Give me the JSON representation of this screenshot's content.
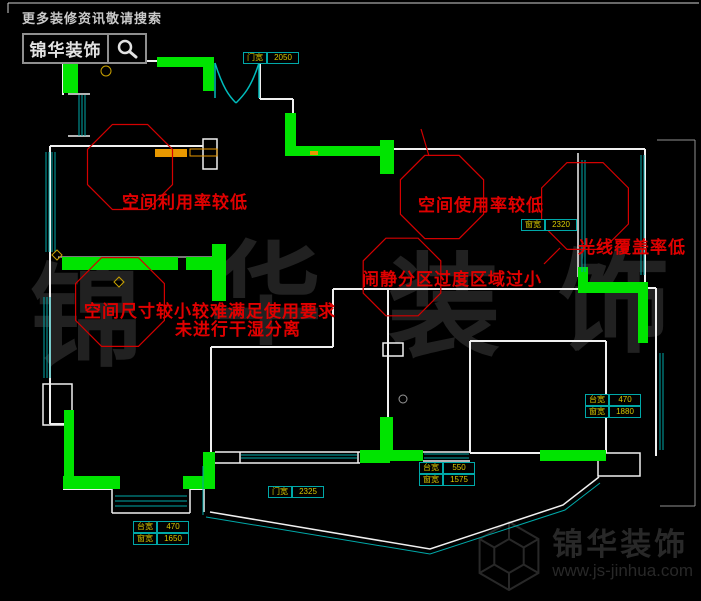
{
  "header": {
    "tagline": "更多装修资讯敬请搜索",
    "brand": "锦华装饰",
    "search_icon": "magnifier-icon"
  },
  "annotations": [
    {
      "text": "空间利用率较低"
    },
    {
      "text": "空间使用率较低"
    },
    {
      "text": "光线覆盖率低"
    },
    {
      "text": "闹静分区过度区域过小"
    },
    {
      "text": "空间尺寸较小较难满足使用要求"
    },
    {
      "text": "未进行干湿分离"
    }
  ],
  "dims": [
    {
      "rows": [
        {
          "label": "门宽",
          "value": "2050"
        }
      ]
    },
    {
      "rows": [
        {
          "label": "窗宽",
          "value": "2320"
        }
      ]
    },
    {
      "rows": [
        {
          "label": "台宽",
          "value": "470"
        },
        {
          "label": "窗宽",
          "value": "1880"
        }
      ]
    },
    {
      "rows": [
        {
          "label": "台宽",
          "value": "550"
        },
        {
          "label": "窗宽",
          "value": "1575"
        }
      ]
    },
    {
      "rows": [
        {
          "label": "门宽",
          "value": "2325"
        }
      ]
    },
    {
      "rows": [
        {
          "label": "台宽",
          "value": "470"
        },
        {
          "label": "窗宽",
          "value": "1650"
        }
      ]
    }
  ],
  "watermark": {
    "chars": [
      "锦",
      "华",
      "装",
      "饰"
    ]
  },
  "footer": {
    "brand": "锦华装饰",
    "url": "www.js-jinhua.com",
    "logo_icon": "hexagon-cube-logo"
  },
  "colors": {
    "background": "#000000",
    "wall": "#f0f0f0",
    "wall_highlight": "#00e400",
    "window": "#00a8a8",
    "annotation_red": "#e00000",
    "cloud_red": "#d40000",
    "dimension_text": "#d8c800",
    "watermark_gray": "#212121"
  }
}
